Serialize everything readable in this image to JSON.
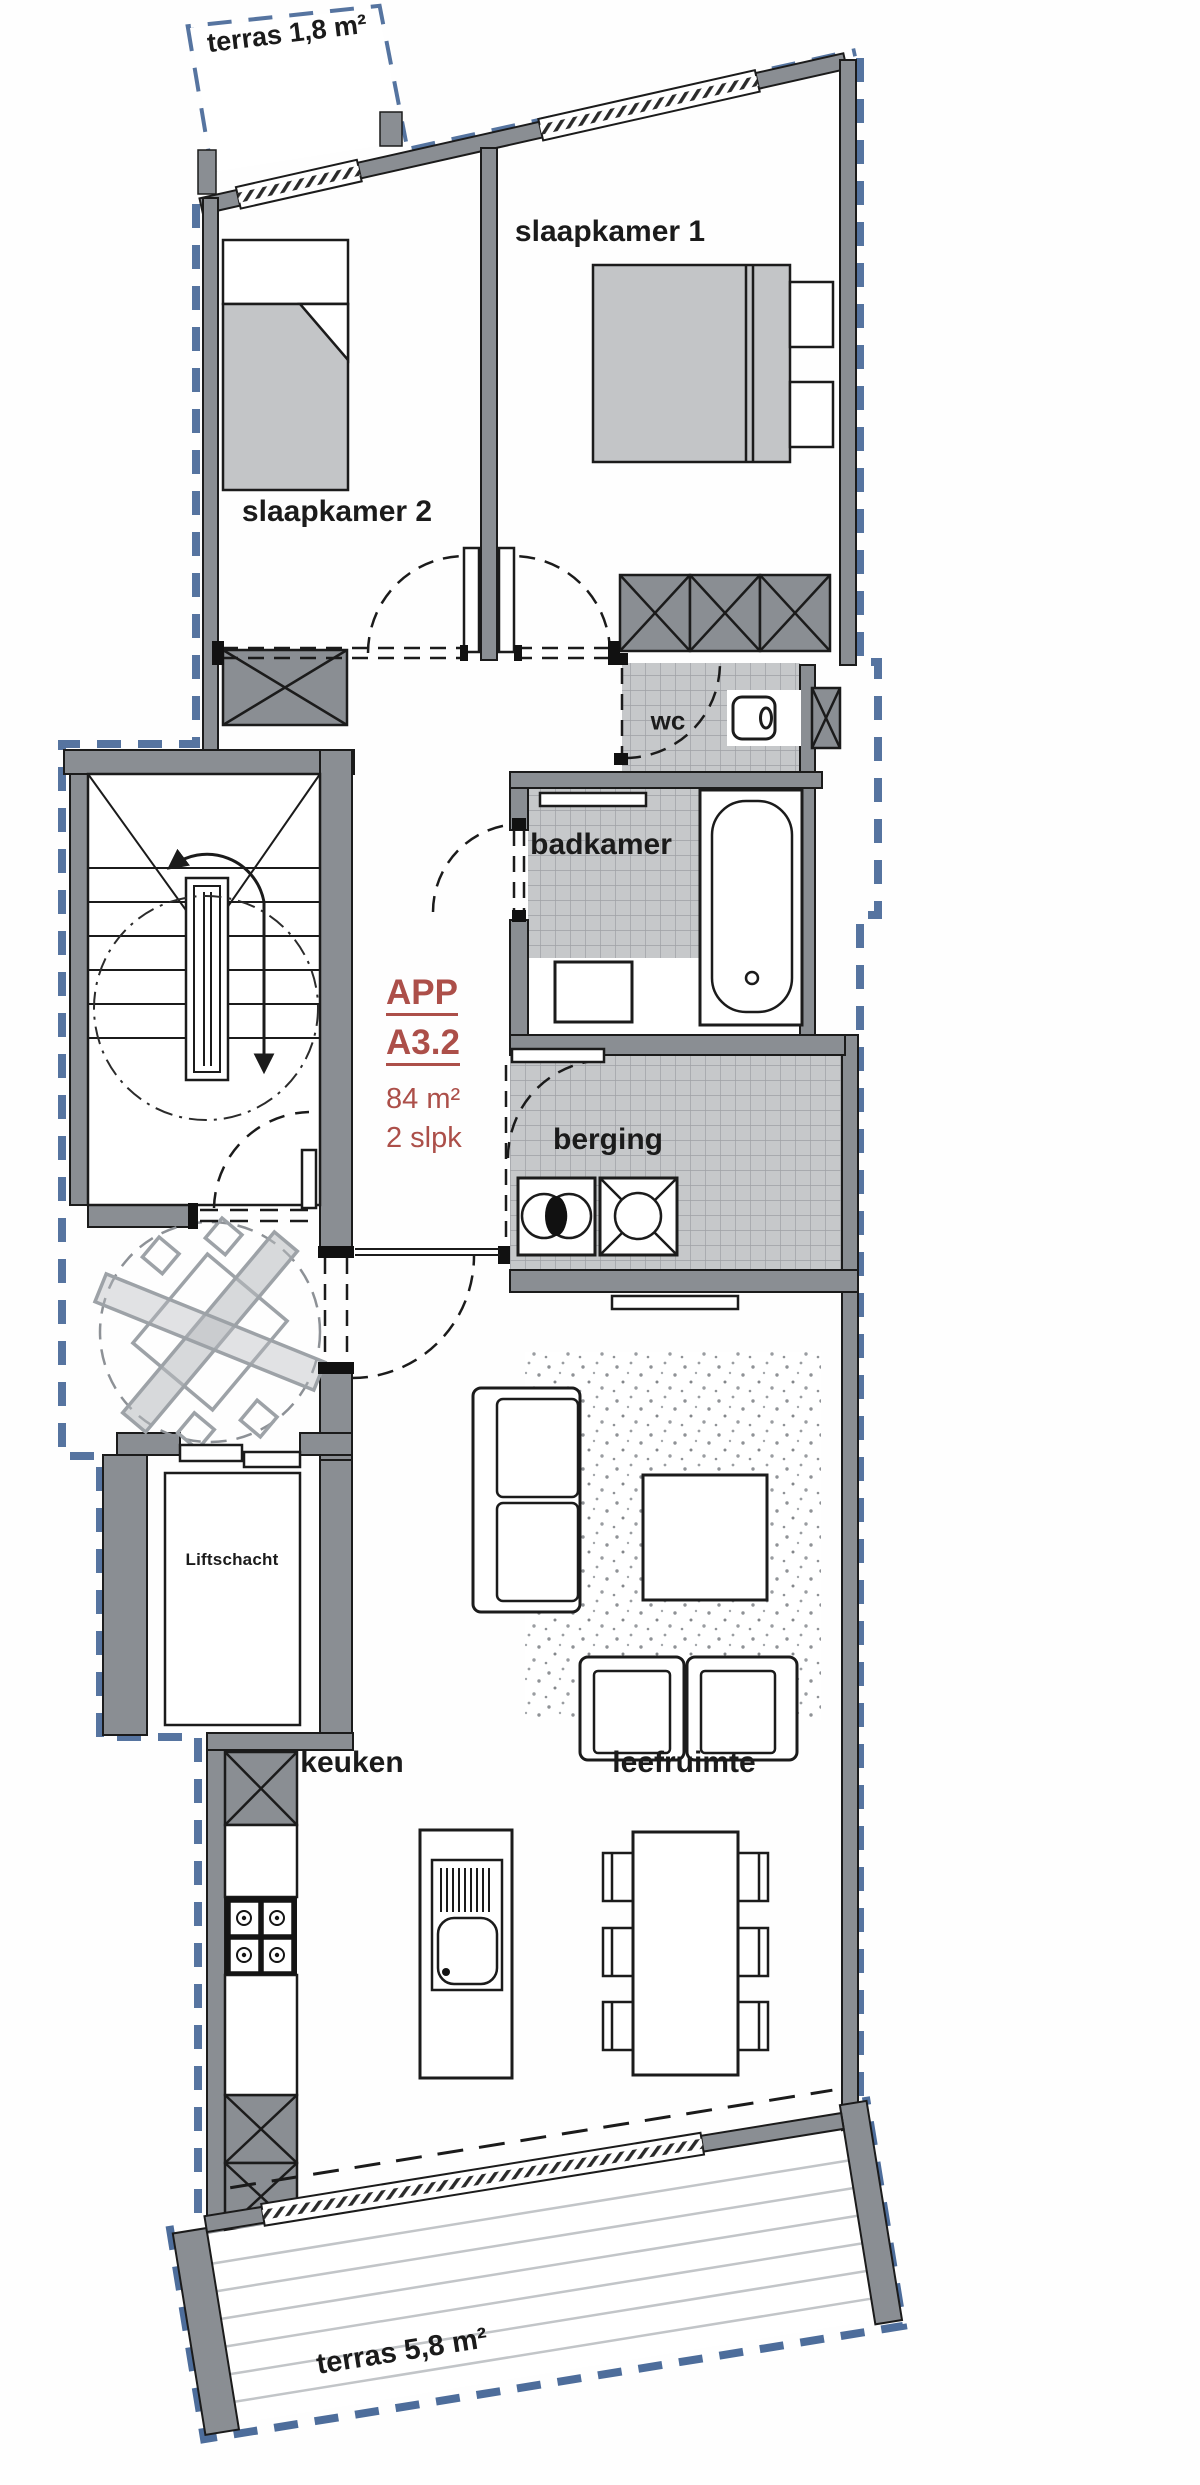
{
  "unit_card": {
    "code": "APP",
    "number": "A3.2",
    "area": "84 m²",
    "bedrooms": "2 slpk",
    "accent_color": "#ac4f49"
  },
  "rooms": {
    "terrace_top": {
      "label": "terras 1,8 m²"
    },
    "bedroom1": {
      "label": "slaapkamer 1"
    },
    "bedroom2": {
      "label": "slaapkamer 2"
    },
    "wc": {
      "label": "wc"
    },
    "bathroom": {
      "label": "badkamer"
    },
    "storage": {
      "label": "berging"
    },
    "lift_shaft": {
      "label": "Liftschacht"
    },
    "kitchen": {
      "label": "keuken"
    },
    "living": {
      "label": "leefruimte"
    },
    "terrace_bottom": {
      "label": "terras 5,8 m²"
    }
  },
  "colors": {
    "wall_gray": "#8a8e93",
    "tile_gray": "#c6c8ca",
    "furniture_gray": "#c3c5c7",
    "boundary_blue": "#4d6d9b",
    "line_black": "#1b1b1b"
  }
}
